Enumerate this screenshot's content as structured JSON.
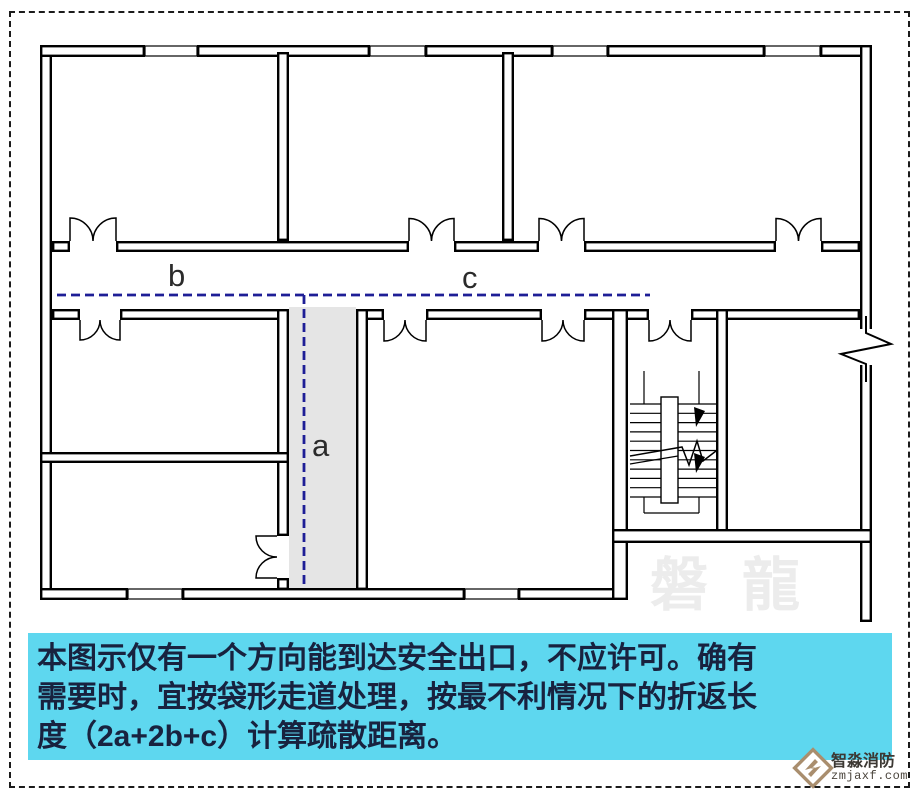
{
  "colors": {
    "wall": "#000000",
    "dashed_path": "#1e1e96",
    "corridor_fill": "#e5e5e5",
    "panel_bg": "#5ed7ef",
    "panel_text": "#18223f",
    "label_text": "#2b2b2b",
    "watermark": "#ececec",
    "logo_brown": "#a98e6e"
  },
  "plan": {
    "gray_corridor": [
      289,
      307,
      67,
      283
    ],
    "walls": [
      [
        40,
        45,
        12,
        555
      ],
      [
        40,
        45,
        105,
        12
      ],
      [
        197,
        45,
        173,
        12
      ],
      [
        425,
        45,
        128,
        12
      ],
      [
        607,
        45,
        158,
        12
      ],
      [
        820,
        45,
        52,
        12
      ],
      [
        860,
        45,
        12,
        577
      ],
      [
        40,
        588,
        88,
        12
      ],
      [
        182,
        588,
        283,
        12
      ],
      [
        518,
        588,
        110,
        12
      ],
      [
        277,
        52,
        12,
        189
      ],
      [
        502,
        52,
        12,
        189
      ],
      [
        52,
        241,
        18,
        11
      ],
      [
        116,
        241,
        293,
        11
      ],
      [
        454,
        241,
        85,
        11
      ],
      [
        584,
        241,
        192,
        11
      ],
      [
        821,
        241,
        39,
        11
      ],
      [
        52,
        309,
        28,
        11
      ],
      [
        120,
        309,
        168,
        11
      ],
      [
        356,
        309,
        28,
        11
      ],
      [
        426,
        309,
        116,
        11
      ],
      [
        584,
        309,
        65,
        11
      ],
      [
        691,
        309,
        169,
        11
      ],
      [
        277,
        309,
        12,
        227
      ],
      [
        277,
        578,
        12,
        12
      ],
      [
        356,
        309,
        12,
        281
      ],
      [
        612,
        309,
        16,
        291
      ],
      [
        716,
        309,
        12,
        234
      ],
      [
        40,
        452,
        249,
        11
      ],
      [
        612,
        529,
        260,
        14
      ]
    ],
    "windows": [
      [
        145,
        46,
        52,
        10
      ],
      [
        370,
        46,
        55,
        10
      ],
      [
        553,
        46,
        54,
        10
      ],
      [
        765,
        46,
        55,
        10
      ],
      [
        128,
        589,
        54,
        10
      ],
      [
        465,
        589,
        53,
        10
      ]
    ],
    "doors": [
      {
        "x": 70,
        "w": 46,
        "y": 241,
        "dir": "up"
      },
      {
        "x": 409,
        "w": 45,
        "y": 241,
        "dir": "up"
      },
      {
        "x": 539,
        "w": 45,
        "y": 241,
        "dir": "up"
      },
      {
        "x": 776,
        "w": 45,
        "y": 241,
        "dir": "up"
      },
      {
        "x": 80,
        "w": 40,
        "y": 320,
        "dir": "down"
      },
      {
        "x": 384,
        "w": 42,
        "y": 320,
        "dir": "down"
      },
      {
        "x": 542,
        "w": 42,
        "y": 320,
        "dir": "down"
      },
      {
        "x": 649,
        "w": 42,
        "y": 320,
        "dir": "down"
      },
      {
        "x": 277,
        "w": 42,
        "y": 536,
        "dir": "left"
      }
    ],
    "dashed_lines": [
      {
        "x1": 57,
        "y1": 295,
        "x2": 650,
        "y2": 295
      },
      {
        "x1": 304,
        "y1": 295,
        "x2": 304,
        "y2": 585
      }
    ],
    "labels": [
      {
        "text": "b",
        "x": 168,
        "y": 260
      },
      {
        "text": "c",
        "x": 462,
        "y": 262
      },
      {
        "text": "a",
        "x": 312,
        "y": 430
      }
    ],
    "stairs": {
      "tread_x1": 630,
      "tread_x2": 716,
      "tread_y1": 404,
      "tread_y2": 497,
      "tread_count": 11,
      "stringer": [
        661,
        397,
        17,
        106
      ],
      "rails": [
        [
          644,
          371,
          644,
          404
        ],
        [
          699,
          371,
          699,
          404
        ],
        [
          644,
          497,
          644,
          513
        ],
        [
          699,
          497,
          699,
          513
        ],
        [
          644,
          513,
          699,
          513
        ]
      ],
      "break_path_1": "M630,456 L682,447 L689,465 L697,441 L703,461 L716,451",
      "break_path_2": "M630,464 L678,456",
      "arrows": [
        [
          694,
          407,
          705,
          411,
          696,
          427
        ],
        [
          694,
          453,
          705,
          457,
          696,
          473
        ]
      ]
    },
    "wall_break": {
      "clear": [
        856,
        329,
        20,
        36
      ],
      "path": "M866,316 L866,333 L891,344 L841,354 L866,364 L866,382"
    }
  },
  "caption": {
    "lines": [
      "本图示仅有一个方向能到达安全出口，不应许可。确有",
      "需要时，宜按袋形走道处理，按最不利情况下的折返长",
      "度（2a+2b+c）计算疏散距离。"
    ]
  },
  "watermark": {
    "text": "磐龍"
  },
  "logo": {
    "name": "智淼消防",
    "domain": "zmjaxf.com"
  }
}
